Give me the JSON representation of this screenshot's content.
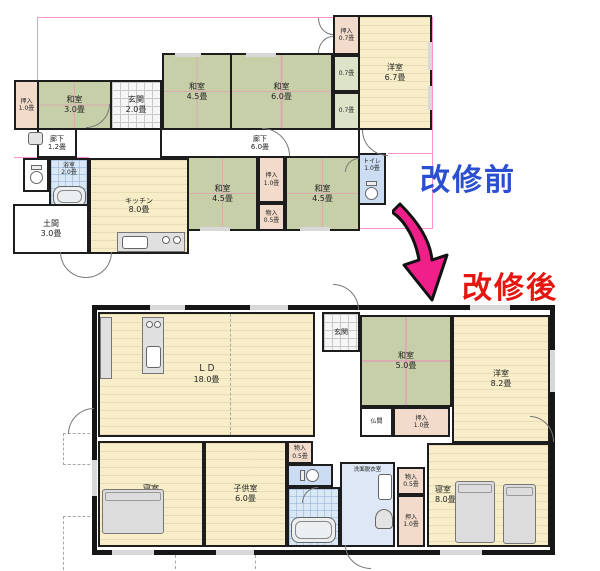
{
  "titles": {
    "before": "改修前",
    "after": "改修後"
  },
  "colors": {
    "before_title": "#2a4fd0",
    "after_title": "#e5150f",
    "arrow": "#f01f8a",
    "tatami": "#c7cfa8",
    "wood_floor": "#f7eec9",
    "closet_pink": "#f2dbcb",
    "wet_blue": "#ccdcf2"
  },
  "before": {
    "rooms": {
      "oshiire_1_0": {
        "name": "押入",
        "size": "1.0畳"
      },
      "washitsu_3_0": {
        "name": "和室",
        "size": "3.0畳"
      },
      "genkan": {
        "name": "玄関",
        "size": "2.0畳"
      },
      "washitsu_4_5a": {
        "name": "和室",
        "size": "4.5畳"
      },
      "washitsu_6_0": {
        "name": "和室",
        "size": "6.0畳"
      },
      "oshiire_0_7": {
        "name": "押入",
        "size": "0.7畳"
      },
      "closet_a": {
        "size": "0.7畳"
      },
      "closet_b": {
        "size": "0.7畳"
      },
      "yoshitsu_6_7": {
        "name": "洋室",
        "size": "6.7畳"
      },
      "rouka_1_2": {
        "name": "廊下",
        "size": "1.2畳"
      },
      "rouka_6_0": {
        "name": "廊下",
        "size": "6.0畳"
      },
      "yokushitsu": {
        "name": "浴室",
        "size": "2.0畳"
      },
      "kitchen": {
        "name": "キッチン",
        "size": "8.0畳"
      },
      "doma": {
        "name": "土間",
        "size": "3.0畳"
      },
      "washitsu_4_5b": {
        "name": "和室",
        "size": "4.5畳"
      },
      "oshiire_1_0b": {
        "name": "押入",
        "size": "1.0畳"
      },
      "monoire_0_5": {
        "name": "物入",
        "size": "0.5畳"
      },
      "washitsu_4_5c": {
        "name": "和室",
        "size": "4.5畳"
      },
      "toilet": {
        "name": "トイレ",
        "size": "1.0畳"
      }
    }
  },
  "after": {
    "rooms": {
      "ld": {
        "name": "ＬＤ",
        "size": "18.0畳"
      },
      "genkan": {
        "name": "玄関"
      },
      "washitsu_5_0": {
        "name": "和室",
        "size": "5.0畳"
      },
      "yoshitsu_8_2": {
        "name": "洋室",
        "size": "8.2畳"
      },
      "butsuma": {
        "name": "仏間"
      },
      "oshiire_1_0a": {
        "name": "押入",
        "size": "1.0畳"
      },
      "shinshitsu_l": {
        "name": "寝室",
        "size": "8.0畳"
      },
      "kodomo": {
        "name": "子供室",
        "size": "6.0畳"
      },
      "monoire_a": {
        "name": "物入",
        "size": "0.5畳"
      },
      "senmen": {
        "name": "洗面脱衣室"
      },
      "monoire_b": {
        "name": "物入",
        "size": "0.5畳"
      },
      "oshiire_1_0b": {
        "name": "押入",
        "size": "1.0畳"
      },
      "shinshitsu_r": {
        "name": "寝室",
        "size": "8.0畳"
      }
    }
  }
}
